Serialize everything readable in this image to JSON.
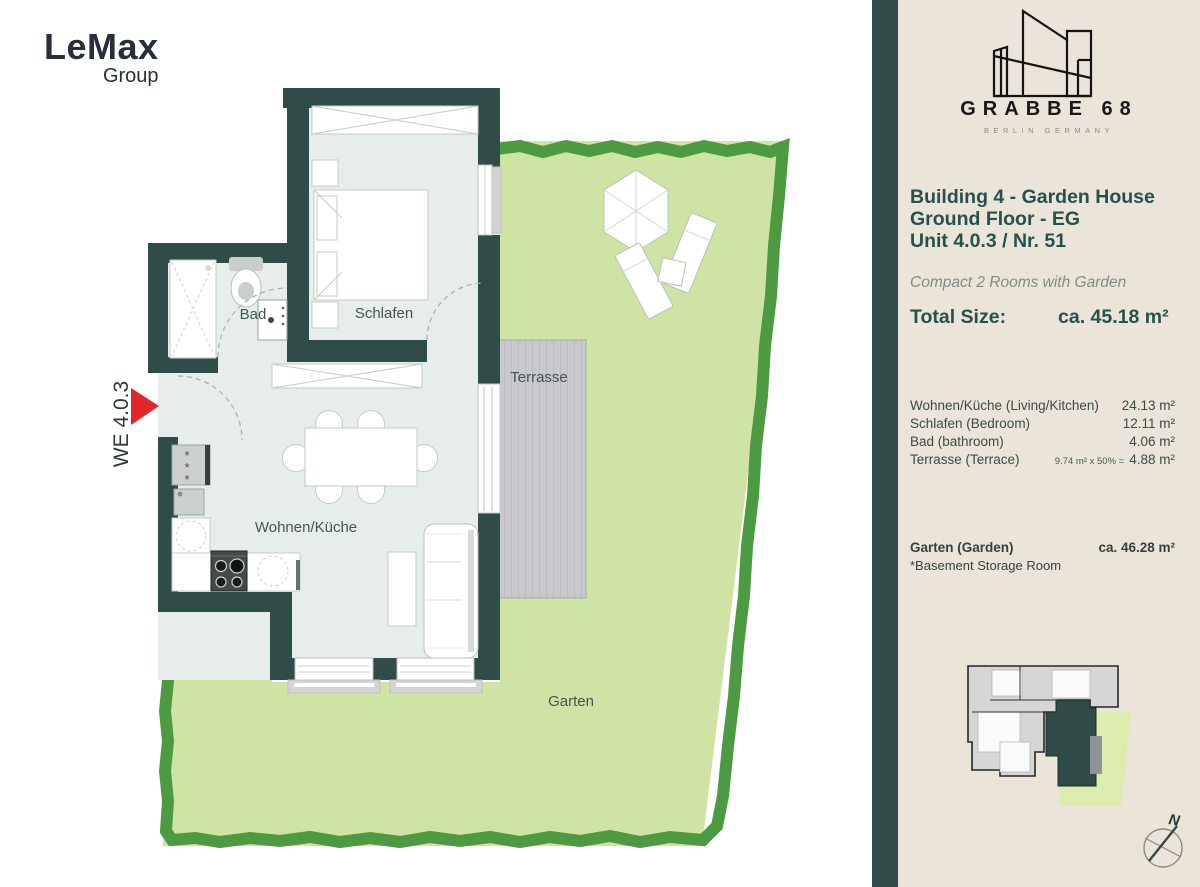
{
  "brand": {
    "name": "LeMax",
    "sub": "Group"
  },
  "logo": {
    "name": "GRABBE 68",
    "location": "BERLIN GERMANY"
  },
  "header": {
    "line1": "Building 4 - Garden House",
    "line2": "Ground Floor - EG",
    "line3": "Unit 4.0.3 / Nr. 51",
    "subtitle": "Compact 2 Rooms with Garden",
    "total_label": "Total Size:",
    "total_value": "ca. 45.18 m²"
  },
  "rooms": [
    {
      "label": "Wohnen/Küche (Living/Kitchen)",
      "value": "24.13 m²"
    },
    {
      "label": "Schlafen (Bedroom)",
      "value": "12.11 m²"
    },
    {
      "label": "Bad (bathroom)",
      "value": "4.06 m²"
    },
    {
      "label": "Terrasse  (Terrace)",
      "calc": "9.74 m² x 50% =",
      "value": "4.88 m²"
    }
  ],
  "garden_row": {
    "label": "Garten (Garden)",
    "value": "ca. 46.28 m²"
  },
  "note": "*Basement Storage Room",
  "plan": {
    "unit": "WE 4.0.3",
    "bad": "Bad",
    "schlafen": "Schlafen",
    "terrasse": "Terrasse",
    "wohnen": "Wohnen/Küche",
    "garten": "Garten"
  },
  "compass": {
    "n": "N"
  },
  "colors": {
    "wall": "#2f4c49",
    "floor": "#e7edeb",
    "garden": "#cfe3a4",
    "garden_border": "#4c9b43",
    "terrace": "#c9c9cd",
    "panel_bg": "#eae4d9",
    "accent_red": "#e3242b",
    "heading_teal": "#27514c"
  }
}
